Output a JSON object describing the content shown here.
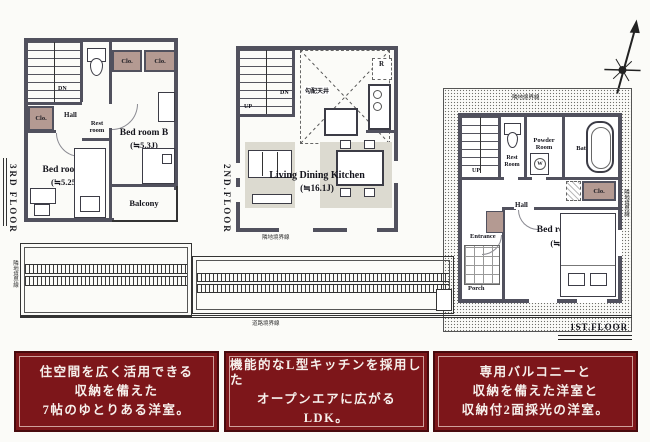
{
  "labels": {
    "clo": "Clo.",
    "hall": "Hall",
    "dn": "DN",
    "up": "UP",
    "r": "R",
    "w": "W",
    "balcony": "Balcony",
    "rest3_1": "Rest",
    "rest3_2": "room",
    "rest1_1": "Rest",
    "rest1_2": "Room",
    "powder1": "Powder",
    "powder2": "Room",
    "bath": "Bath Room",
    "entrance": "Entrance",
    "porch": "Porch"
  },
  "floors": {
    "third": {
      "label": "3RD FLOOR",
      "bedroomB": {
        "name": "Bed room B",
        "size": "(≒5.3J)"
      },
      "bedroomC": {
        "name": "Bed room C",
        "size": "(≒5.25J)"
      }
    },
    "second": {
      "label": "2ND.FLOOR",
      "ldk": {
        "name": "Living Dining Kitchen",
        "size": "(≒16.1J)"
      },
      "ceiling": "勾配天井"
    },
    "first": {
      "label": "1ST.FLOOR",
      "bedroomA": {
        "name": "Bed room A",
        "size": "(≒7J)"
      }
    }
  },
  "site": {
    "adjacent": "隣地境界線",
    "road": "道路境界線"
  },
  "captions": [
    {
      "line1": "住空間を広く活用できる",
      "line2": "収納を備えた",
      "line3": "7帖のゆとりある洋室。"
    },
    {
      "line1": "機能的なL型キッチンを採用した",
      "line2": "オープンエアに広がる",
      "line3": "LDK。"
    },
    {
      "line1": "専用バルコニーと",
      "line2": "収納を備えた洋室と",
      "line3": "収納付2面採光の洋室。"
    }
  ],
  "colors": {
    "wall": "#51515e",
    "closet": "#b49a92",
    "caption_bg": "#7d161a",
    "rug": "#dcdad0"
  }
}
